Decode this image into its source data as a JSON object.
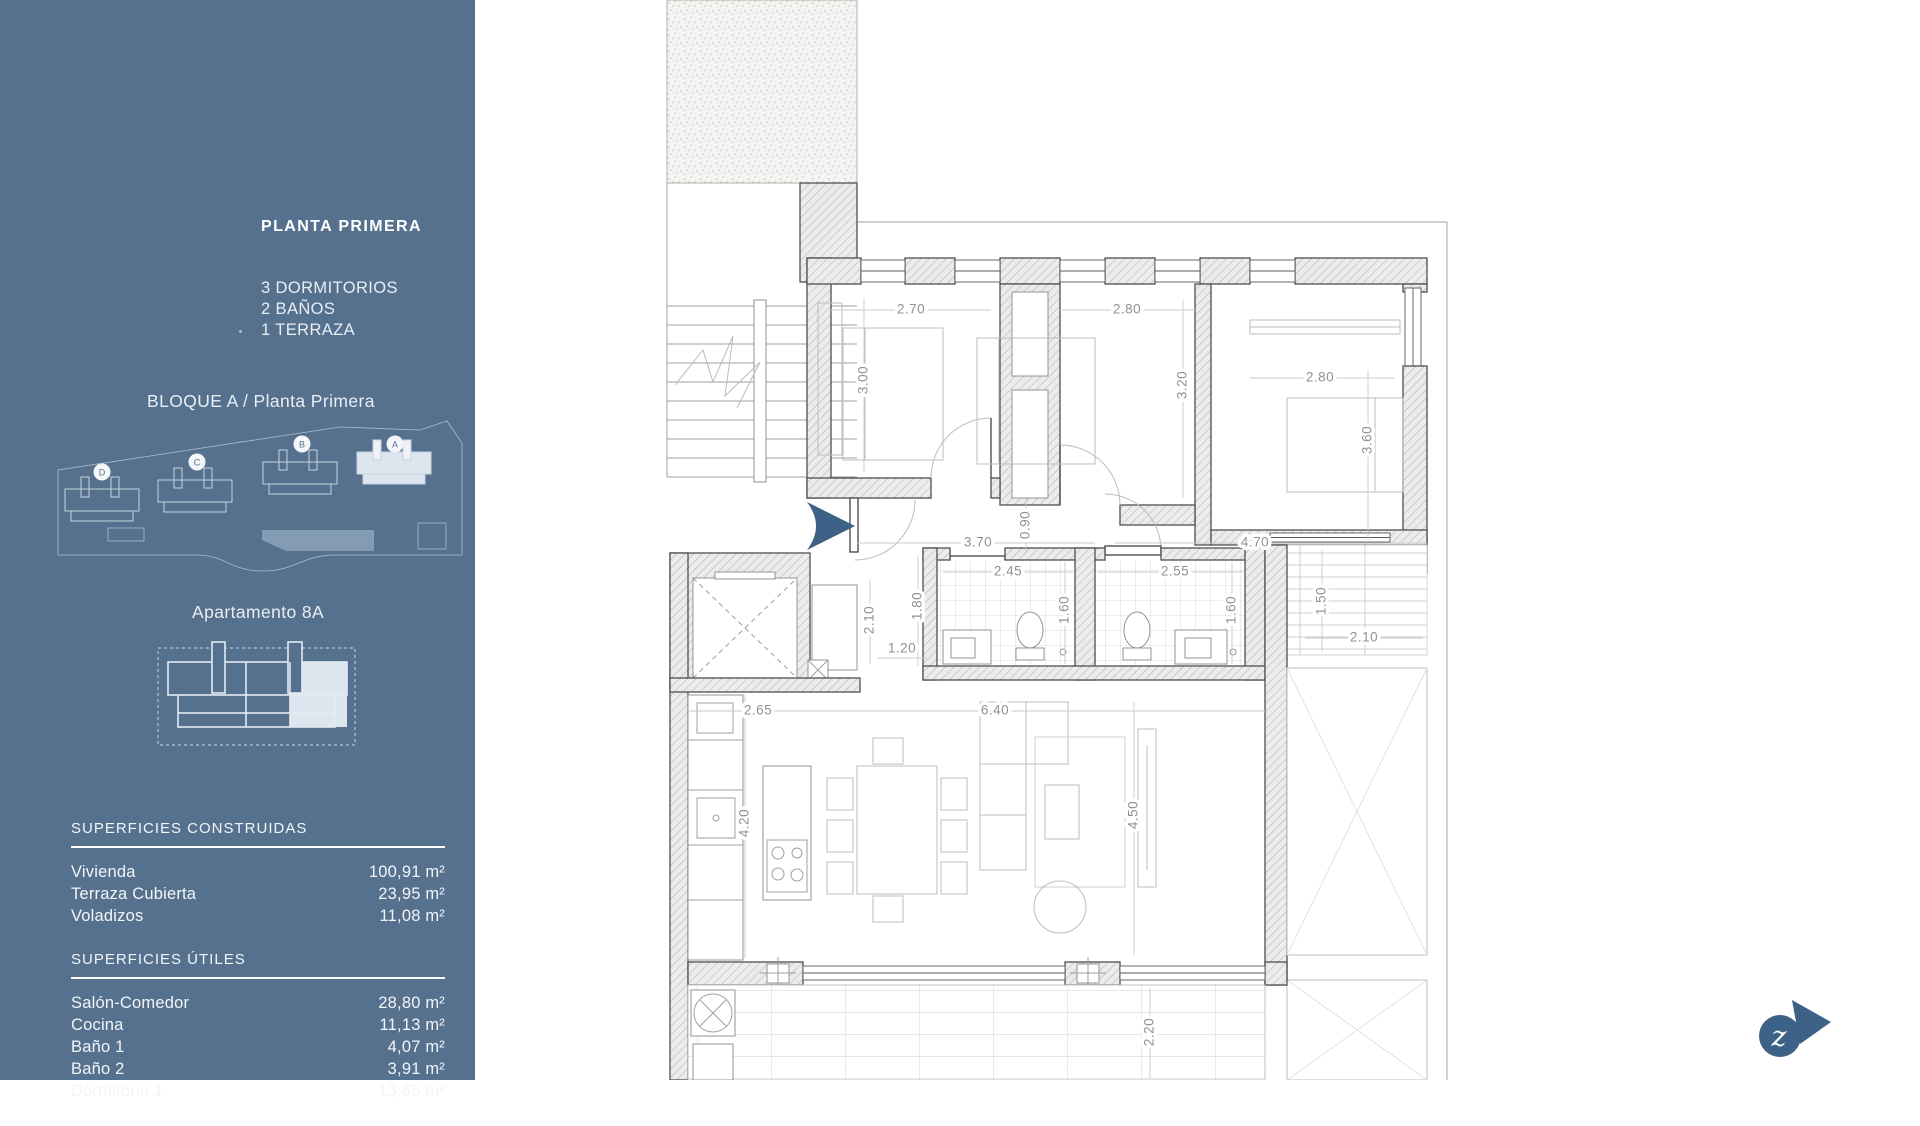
{
  "sidebar": {
    "title": "PLANTA PRIMERA",
    "program": [
      "3 DORMITORIOS",
      "2 BAÑOS",
      "1 TERRAZA"
    ],
    "block_label": "BLOQUE A / Planta Primera",
    "site_buildings": [
      "D",
      "C",
      "B",
      "A"
    ],
    "apartment_label": "Apartamento 8A",
    "tables": [
      {
        "heading": "SUPERFICIES CONSTRUIDAS",
        "rows": [
          {
            "label": "Vivienda",
            "value": "100,91 m²"
          },
          {
            "label": "Terraza Cubierta",
            "value": "23,95 m²"
          },
          {
            "label": "Voladizos",
            "value": "11,08 m²"
          }
        ]
      },
      {
        "heading": "SUPERFICIES ÚTILES",
        "rows": [
          {
            "label": "Salón-Comedor",
            "value": "28,80 m²"
          },
          {
            "label": "Cocina",
            "value": "11,13 m²"
          },
          {
            "label": "Baño 1",
            "value": "4,07 m²"
          },
          {
            "label": "Baño 2",
            "value": "3,91 m²"
          },
          {
            "label": "Dormitorio 1",
            "value": "13,65 m²"
          }
        ]
      }
    ]
  },
  "floorplan": {
    "logo_letter": "z",
    "dimensions": [
      {
        "t": "2.70",
        "x": 436,
        "y": 310,
        "r": 0
      },
      {
        "t": "2.80",
        "x": 652,
        "y": 310,
        "r": 0
      },
      {
        "t": "2.80",
        "x": 845,
        "y": 378,
        "r": 0
      },
      {
        "t": "3.00",
        "x": 389,
        "y": 380,
        "r": 90
      },
      {
        "t": "3.20",
        "x": 708,
        "y": 385,
        "r": 90
      },
      {
        "t": "3.60",
        "x": 893,
        "y": 440,
        "r": 90
      },
      {
        "t": "3.70",
        "x": 503,
        "y": 543,
        "r": 0
      },
      {
        "t": "0.90",
        "x": 551,
        "y": 525,
        "r": 90
      },
      {
        "t": "4.70",
        "x": 780,
        "y": 543,
        "r": 0
      },
      {
        "t": "2.45",
        "x": 533,
        "y": 572,
        "r": 0
      },
      {
        "t": "2.55",
        "x": 700,
        "y": 572,
        "r": 0
      },
      {
        "t": "1.80",
        "x": 443,
        "y": 606,
        "r": 90
      },
      {
        "t": "1.60",
        "x": 590,
        "y": 610,
        "r": 90
      },
      {
        "t": "1.60",
        "x": 757,
        "y": 610,
        "r": 90
      },
      {
        "t": "1.50",
        "x": 847,
        "y": 601,
        "r": 90
      },
      {
        "t": "2.10",
        "x": 889,
        "y": 638,
        "r": 0
      },
      {
        "t": "2.10",
        "x": 395,
        "y": 620,
        "r": 90
      },
      {
        "t": "1.20",
        "x": 427,
        "y": 649,
        "r": 0
      },
      {
        "t": "2.65",
        "x": 283,
        "y": 711,
        "r": 0
      },
      {
        "t": "6.40",
        "x": 520,
        "y": 711,
        "r": 0
      },
      {
        "t": "4.20",
        "x": 270,
        "y": 823,
        "r": 90
      },
      {
        "t": "4.50",
        "x": 659,
        "y": 815,
        "r": 90
      },
      {
        "t": "2.20",
        "x": 675,
        "y": 1032,
        "r": 90
      }
    ]
  },
  "colors": {
    "sidebar": "#55718e",
    "accent": "#3d6187",
    "highlight": "#dde6ef"
  }
}
